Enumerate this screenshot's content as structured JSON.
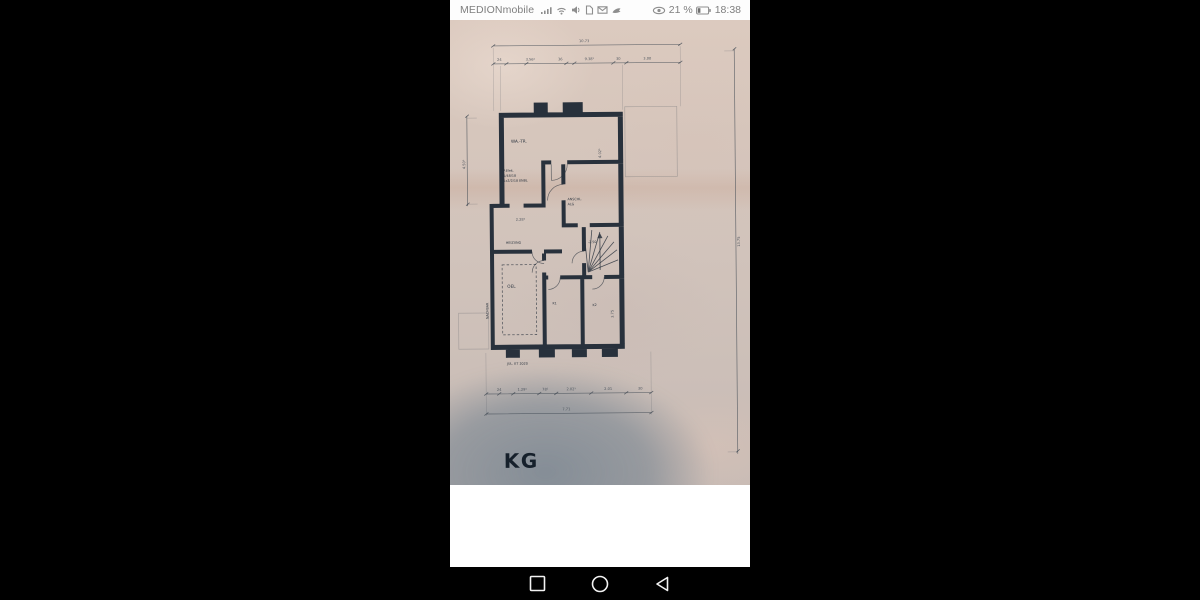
{
  "status_bar": {
    "carrier": "MEDIONmobile",
    "left_icons": [
      "signal-strength-icon",
      "wifi-icon",
      "volume-icon",
      "sim-card-icon",
      "mail-icon",
      "roaming-icon"
    ],
    "visibility_label": "21 %",
    "time": "18:38",
    "right_icons": [
      "visibility-icon",
      "battery-icon"
    ]
  },
  "nav_bar": {
    "buttons": [
      {
        "name": "recents-button",
        "icon": "square-outline-icon"
      },
      {
        "name": "home-button",
        "icon": "circle-outline-icon"
      },
      {
        "name": "back-button",
        "icon": "triangle-left-outline-icon"
      }
    ]
  },
  "floor_plan": {
    "stamp": "KG",
    "date_note": "JUL. ET 2020",
    "rooms": {
      "laundry": "WA.-TR.",
      "connection_line1": "ANSCHL.",
      "connection_line2": "ALG",
      "heating": "HEIZUNG",
      "oil": "OEL",
      "cellar1": "K1",
      "cellar2": "K2"
    },
    "annotations": {
      "neighbor": "NACHBAR",
      "level": "-2.50",
      "note_line1": "P.Elek.",
      "note_line2": "1/48/18",
      "note_line3": "1x2/2/18 ENBL"
    },
    "dimensions": {
      "top_total": "10.73",
      "top_segments": [
        "24",
        "3.56⁵",
        "36",
        "9.38⁵",
        "30",
        "3.00"
      ],
      "right_total": "13.75",
      "left_height": "4.50⁵",
      "room_height": "4.02⁵",
      "mid_width": "2.28⁵",
      "cellar2_height": "3.75",
      "bottom_segments": [
        "24",
        "1.29⁵",
        "78⁵",
        "2.02⁵",
        "2.01",
        "30"
      ],
      "bottom_total": "7.71"
    },
    "colors": {
      "paper": "#d3c4bb",
      "ink": "#28313c",
      "shadow_tint": "#546c80"
    }
  }
}
